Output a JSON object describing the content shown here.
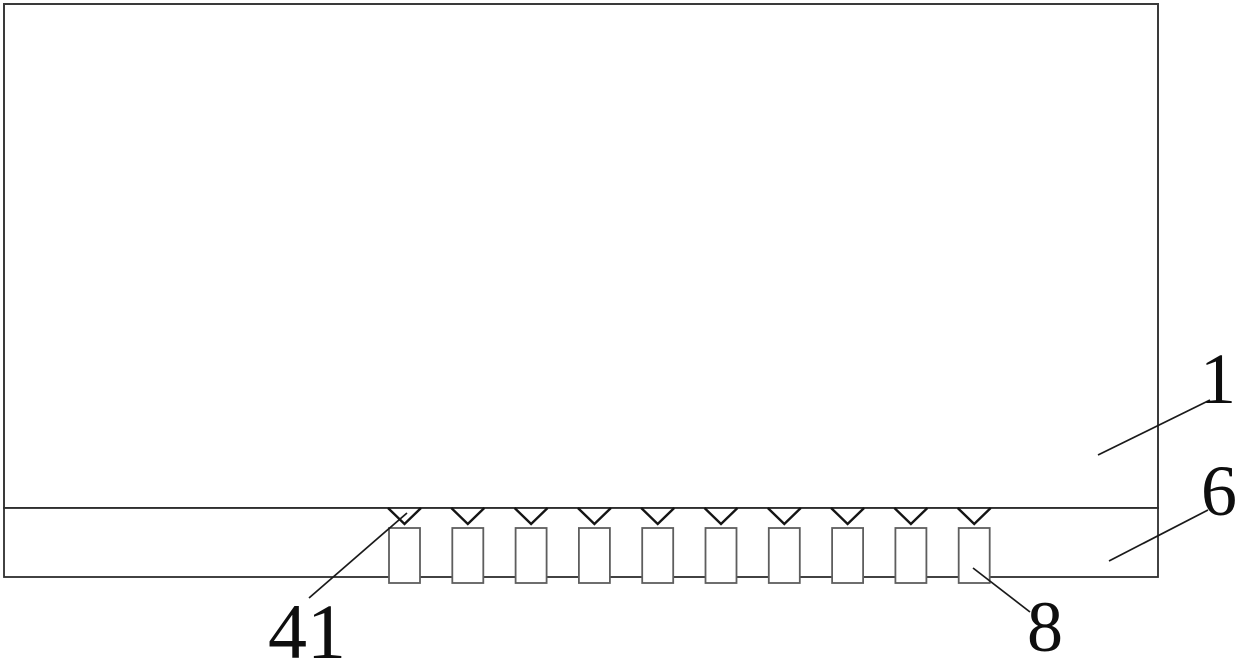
{
  "figure": {
    "kind": "patent-line-drawing",
    "description": "Cross-section drawing of a panel body (1) over a base strip (6) carrying a row of rectangular blocks (8), each marked with a V-notch (41)",
    "background_color": "#ffffff",
    "line_color": "#1a1a1a",
    "block_stroke_color": "#5e5e5e",
    "reference_labels": {
      "panel_body": "1",
      "base_strip": "6",
      "v_notch": "41",
      "block": "8"
    },
    "teeth": {
      "count": 10,
      "first_center_x": 404.5,
      "spacing": 63.3,
      "chevron": {
        "half_width": 16.5,
        "top_y": 508,
        "apex_y": 524
      },
      "block": {
        "width": 31,
        "top": 528,
        "height": 55
      }
    }
  }
}
